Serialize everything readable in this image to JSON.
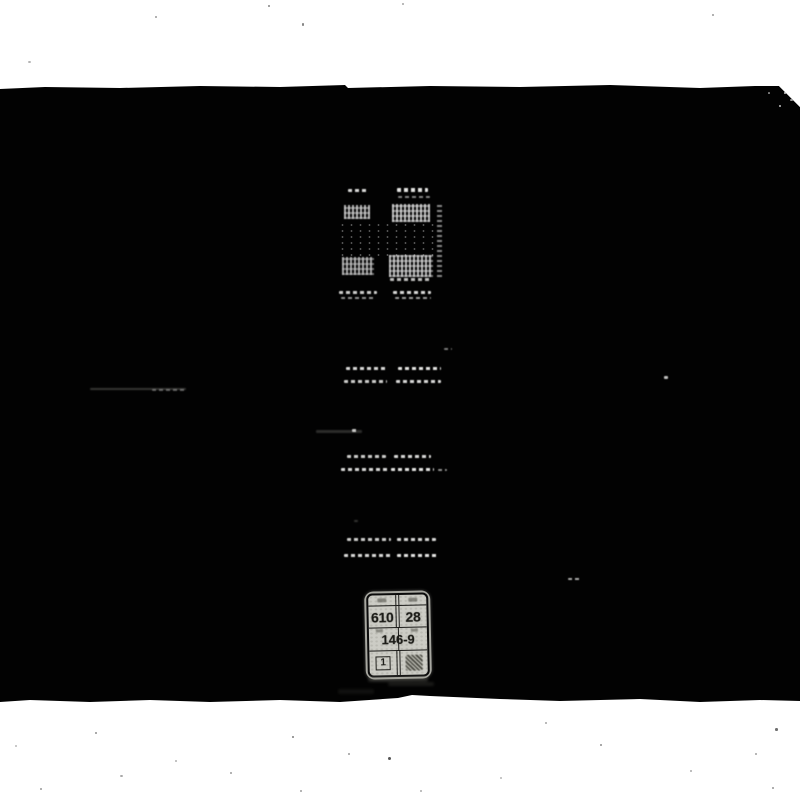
{
  "scan": {
    "description": "Black-and-white scan of a worn black book cover opened flat, spine in center with faint tooled bands and a library label near the foot of the spine"
  },
  "colors": {
    "page_background": "#ffffff",
    "cover_black": "#020202",
    "label_paper": "#ccccc5",
    "label_ink": "#1b1b17",
    "spine_highlight": "#fcfcfa"
  },
  "spine_label": {
    "call_number_top_left": "610",
    "call_number_top_right": "28",
    "call_number_middle": "146-9",
    "copy_number": "1"
  }
}
